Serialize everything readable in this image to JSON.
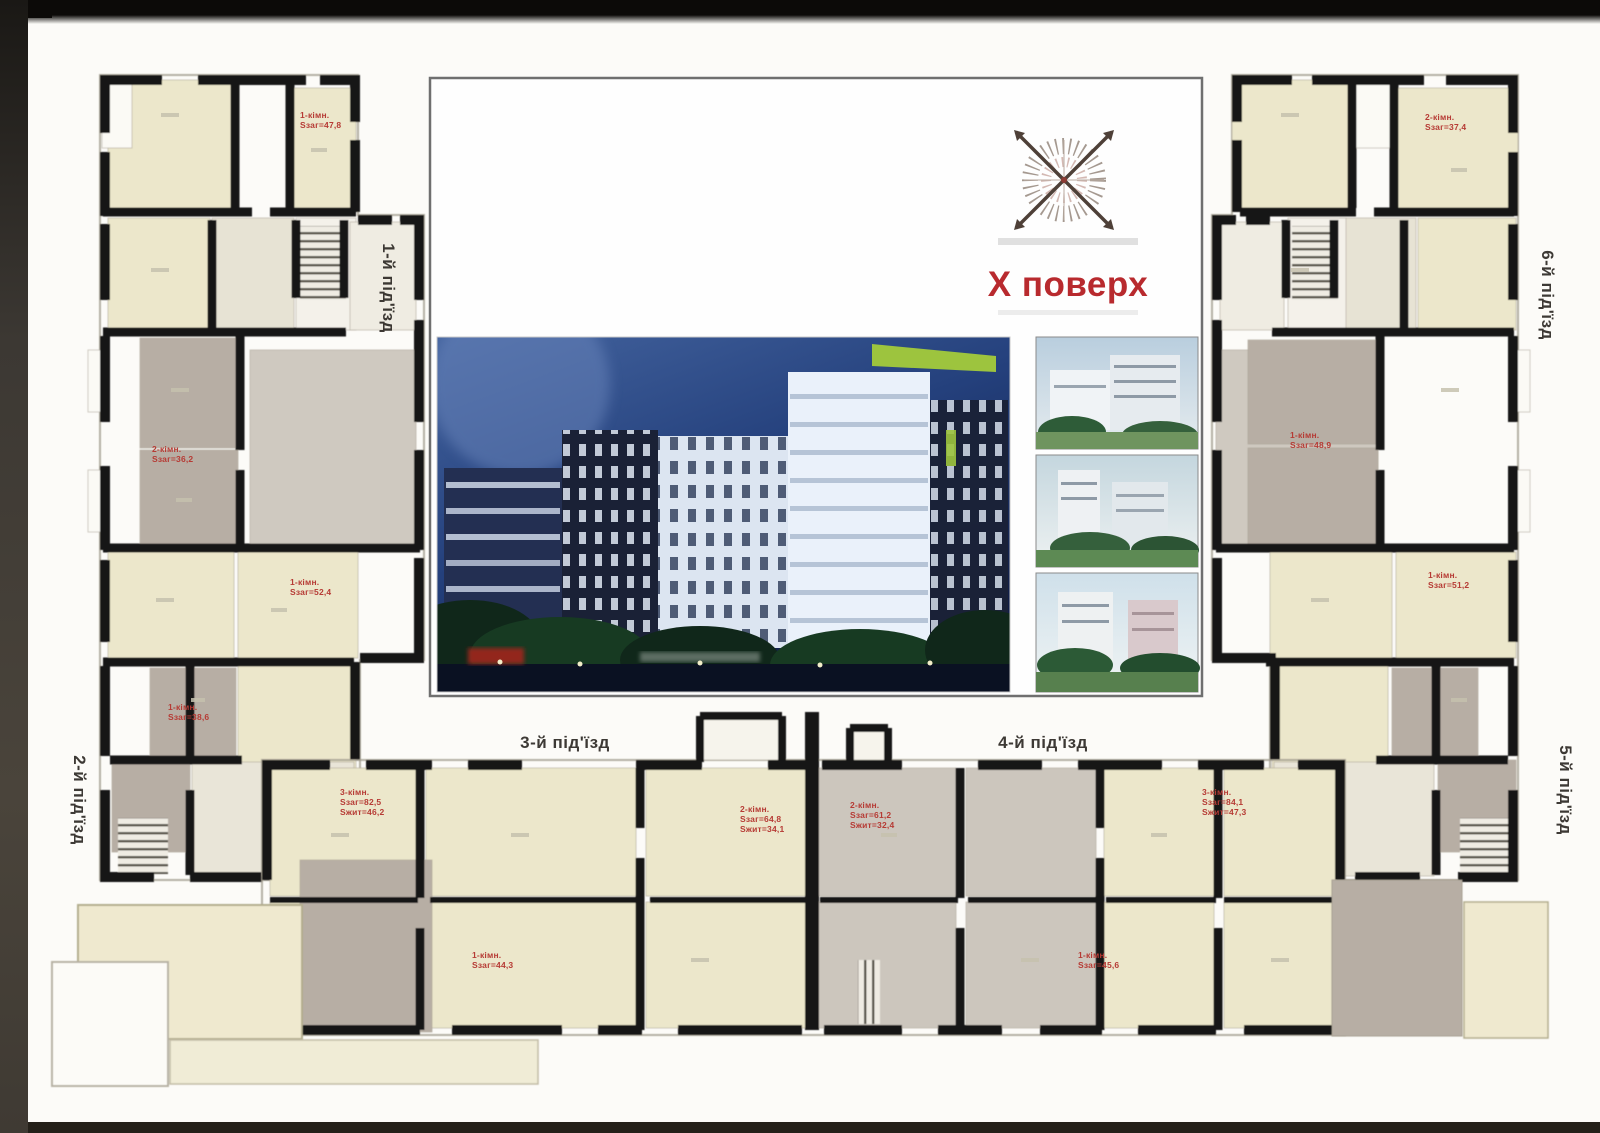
{
  "panel": {
    "floor_title": "Х поверх"
  },
  "entrances": [
    {
      "text": "1-й під'їзд"
    },
    {
      "text": "2-й під'їзд"
    },
    {
      "text": "3-й під'їзд"
    },
    {
      "text": "4-й під'їзд"
    },
    {
      "text": "5-й під'їзд"
    },
    {
      "text": "6-й під'їзд"
    }
  ],
  "apt_labels": [
    {
      "lines": [
        "1-кімн.",
        "Sзаг=47,8"
      ]
    },
    {
      "lines": [
        "2-кімн.",
        "Sзаг=36,2"
      ]
    },
    {
      "lines": [
        "1-кімн.",
        "Sзаг=52,4"
      ]
    },
    {
      "lines": [
        "1-кімн.",
        "Sзаг=38,6"
      ]
    },
    {
      "lines": [
        "3-кімн.",
        "Sзаг=82,5",
        "Sжит=46,2"
      ]
    },
    {
      "lines": [
        "1-кімн.",
        "Sзаг=44,3"
      ]
    },
    {
      "lines": [
        "2-кімн.",
        "Sзаг=64,8",
        "Sжит=34,1"
      ]
    },
    {
      "lines": [
        "2-кімн.",
        "Sзаг=61,2",
        "Sжит=32,4"
      ]
    },
    {
      "lines": [
        "1-кімн.",
        "Sзаг=45,6"
      ]
    },
    {
      "lines": [
        "3-кімн.",
        "Sзаг=84,1",
        "Sжит=47,3"
      ]
    },
    {
      "lines": [
        "1-кімн.",
        "Sзаг=48,9"
      ]
    },
    {
      "lines": [
        "2-кімн.",
        "Sзаг=37,4"
      ]
    },
    {
      "lines": [
        "1-кімн.",
        "Sзаг=51,2"
      ]
    }
  ],
  "colors": {
    "wall": "#171412",
    "room_cream": "#ece7cb",
    "room_gray": "#b7aea4",
    "room_gray_light": "#ccc6bd",
    "corridor": "#e7e3d4",
    "red_label": "#b63a34",
    "panel_border": "#6f6f6f",
    "panel_bg": "#fefefe",
    "top_bar": "#0c0a08",
    "side_strip": "#3c3833",
    "photo_sky": "#2c4a8c",
    "accent_green": "#9dc43e"
  },
  "images": {
    "main_photo": "night-render-of-residential-complex",
    "thumb_1": "day-render-1",
    "thumb_2": "day-render-2",
    "thumb_3": "day-render-3"
  }
}
